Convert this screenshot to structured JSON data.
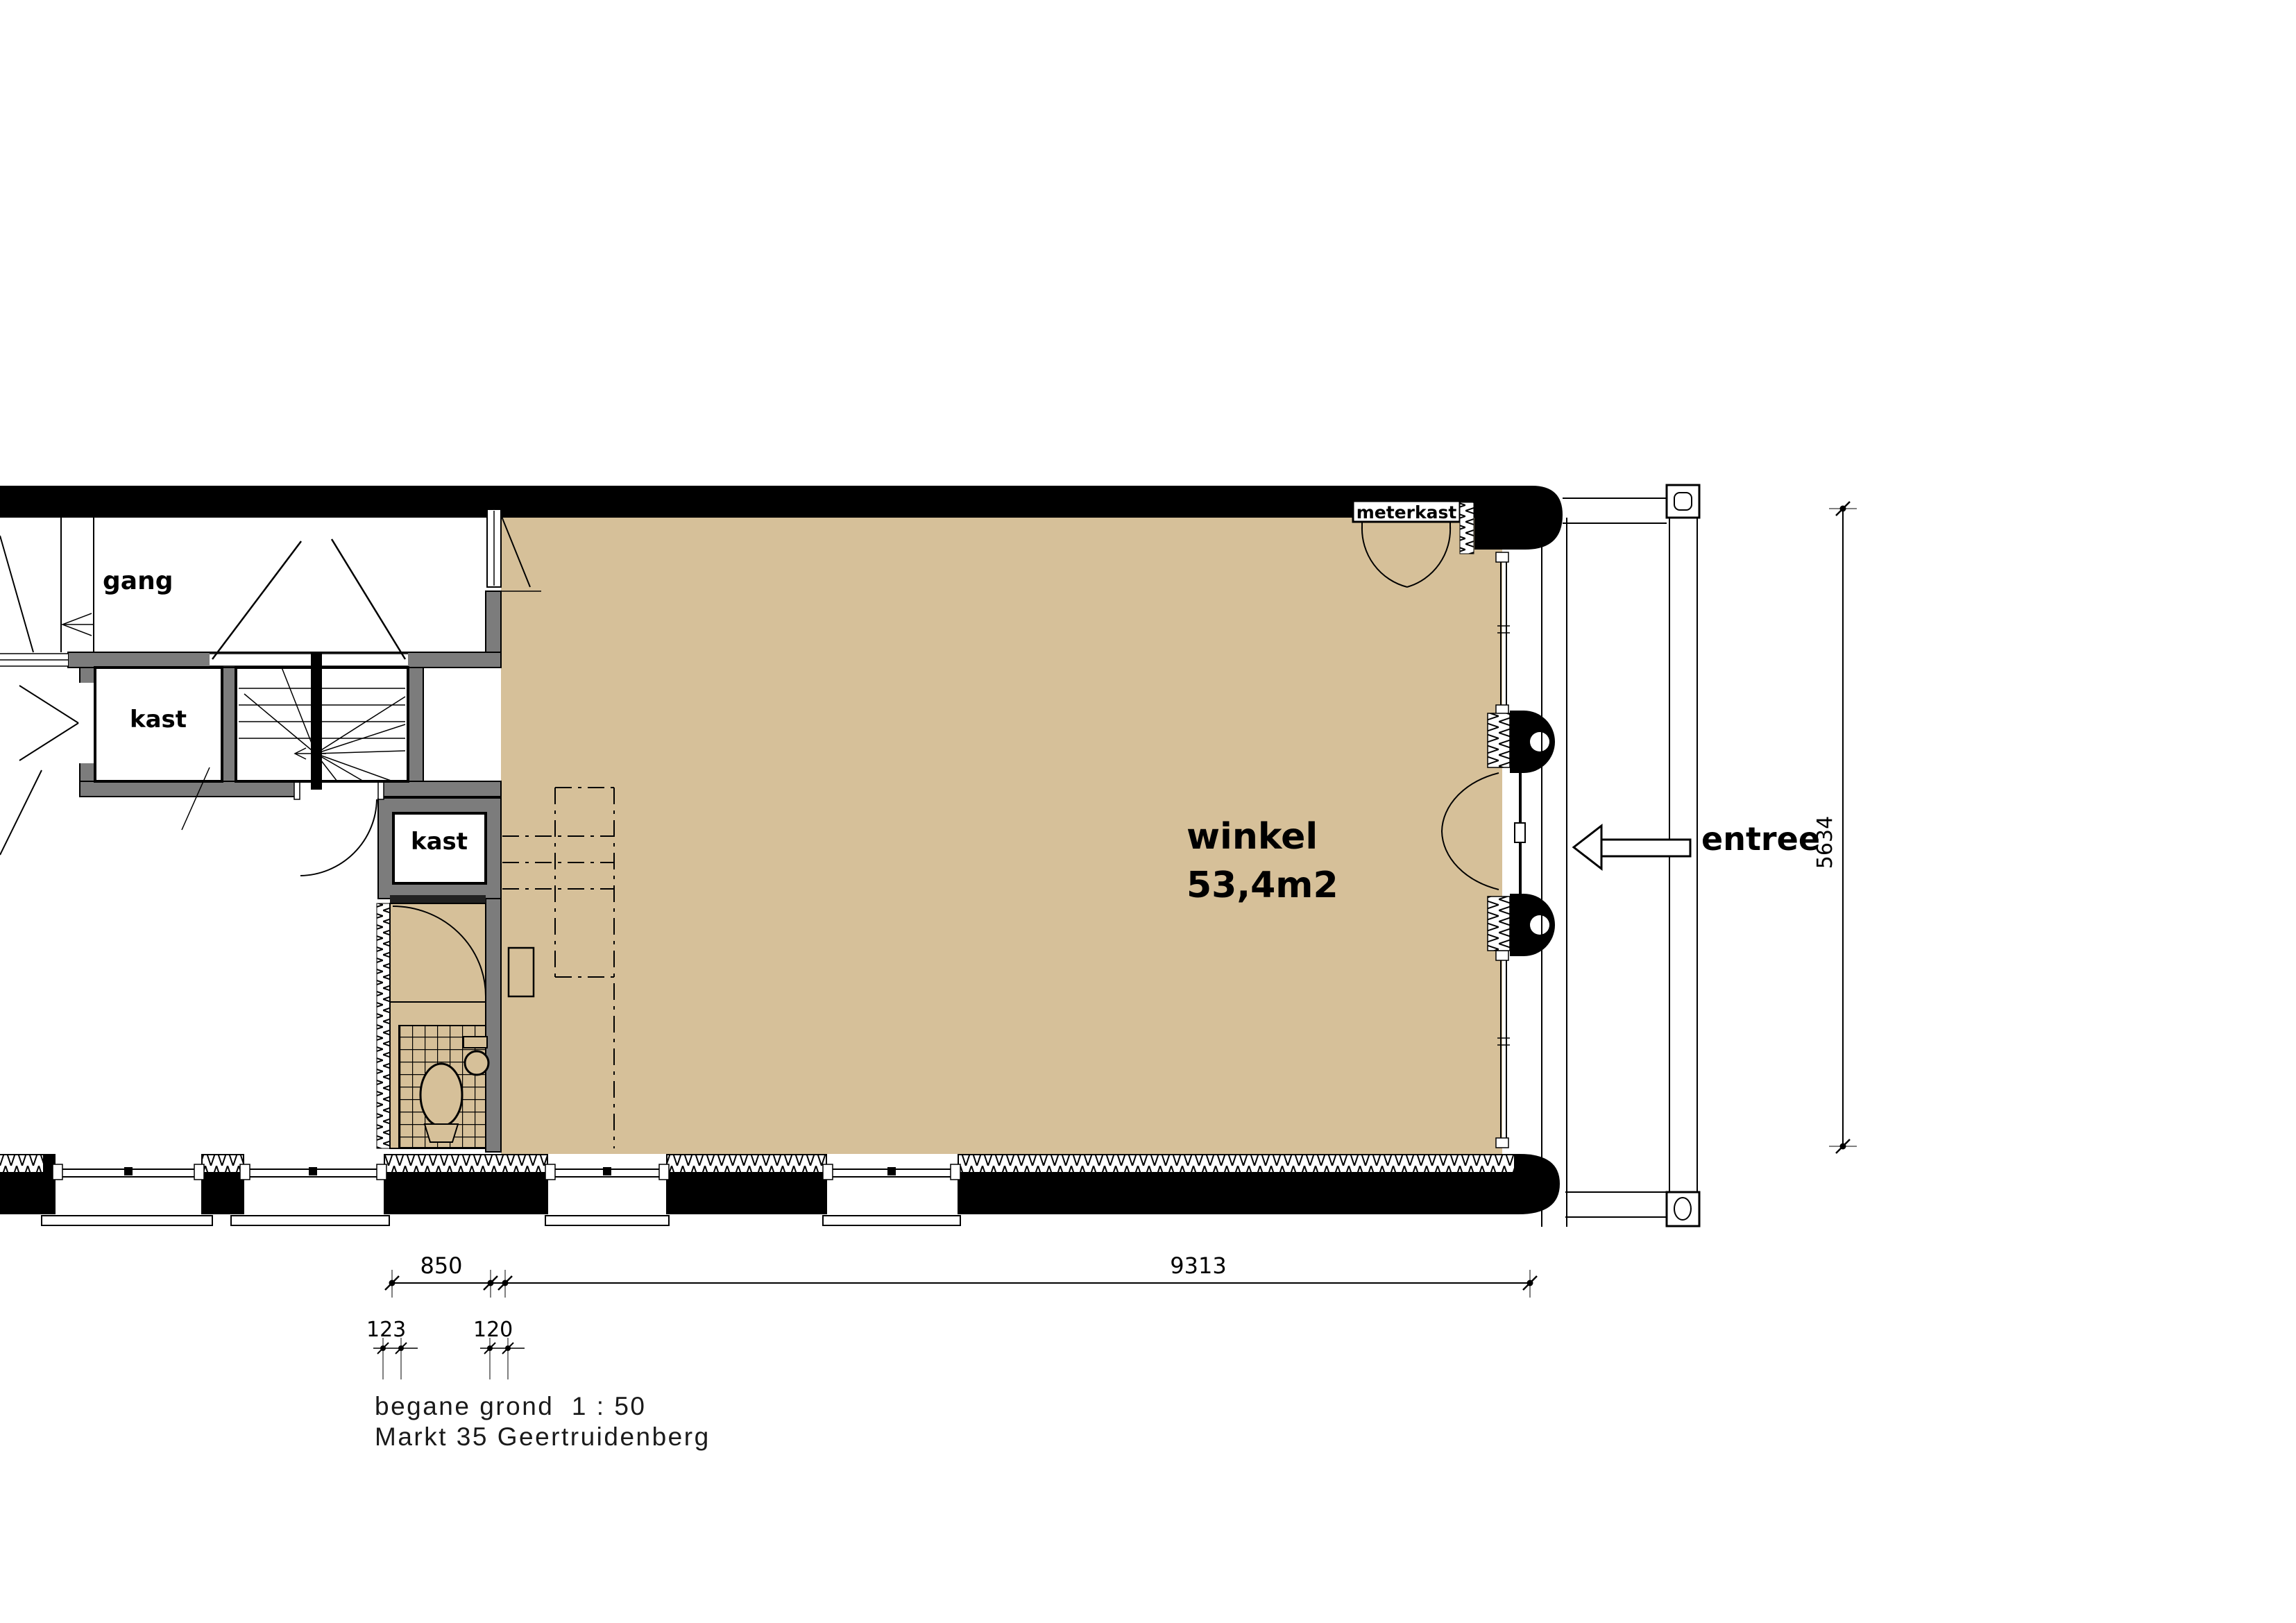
{
  "drawing": {
    "title_scale": "begane grond  1 : 50",
    "title_address": "Markt 35 Geertruidenberg"
  },
  "labels": {
    "gang": "gang",
    "kast_upper": "kast",
    "kast_lower": "kast",
    "meterkast": "meterkast",
    "winkel_name": "winkel",
    "winkel_area": "53,4m2",
    "entree": "entree"
  },
  "dimensions": {
    "left_width": "850",
    "main_width": "9313",
    "sub_left": "123",
    "sub_right": "120",
    "right_height": "5634"
  },
  "symbols": {
    "entree_arrow": "left-pointing entry arrow",
    "columns": "round-capped facade columns",
    "stairs": "winder staircase with direction arrow"
  },
  "colors": {
    "floor_tan": "#d6c099",
    "wall_gray": "#7c7c7c",
    "wall_black": "#000000",
    "paper": "#ffffff"
  }
}
